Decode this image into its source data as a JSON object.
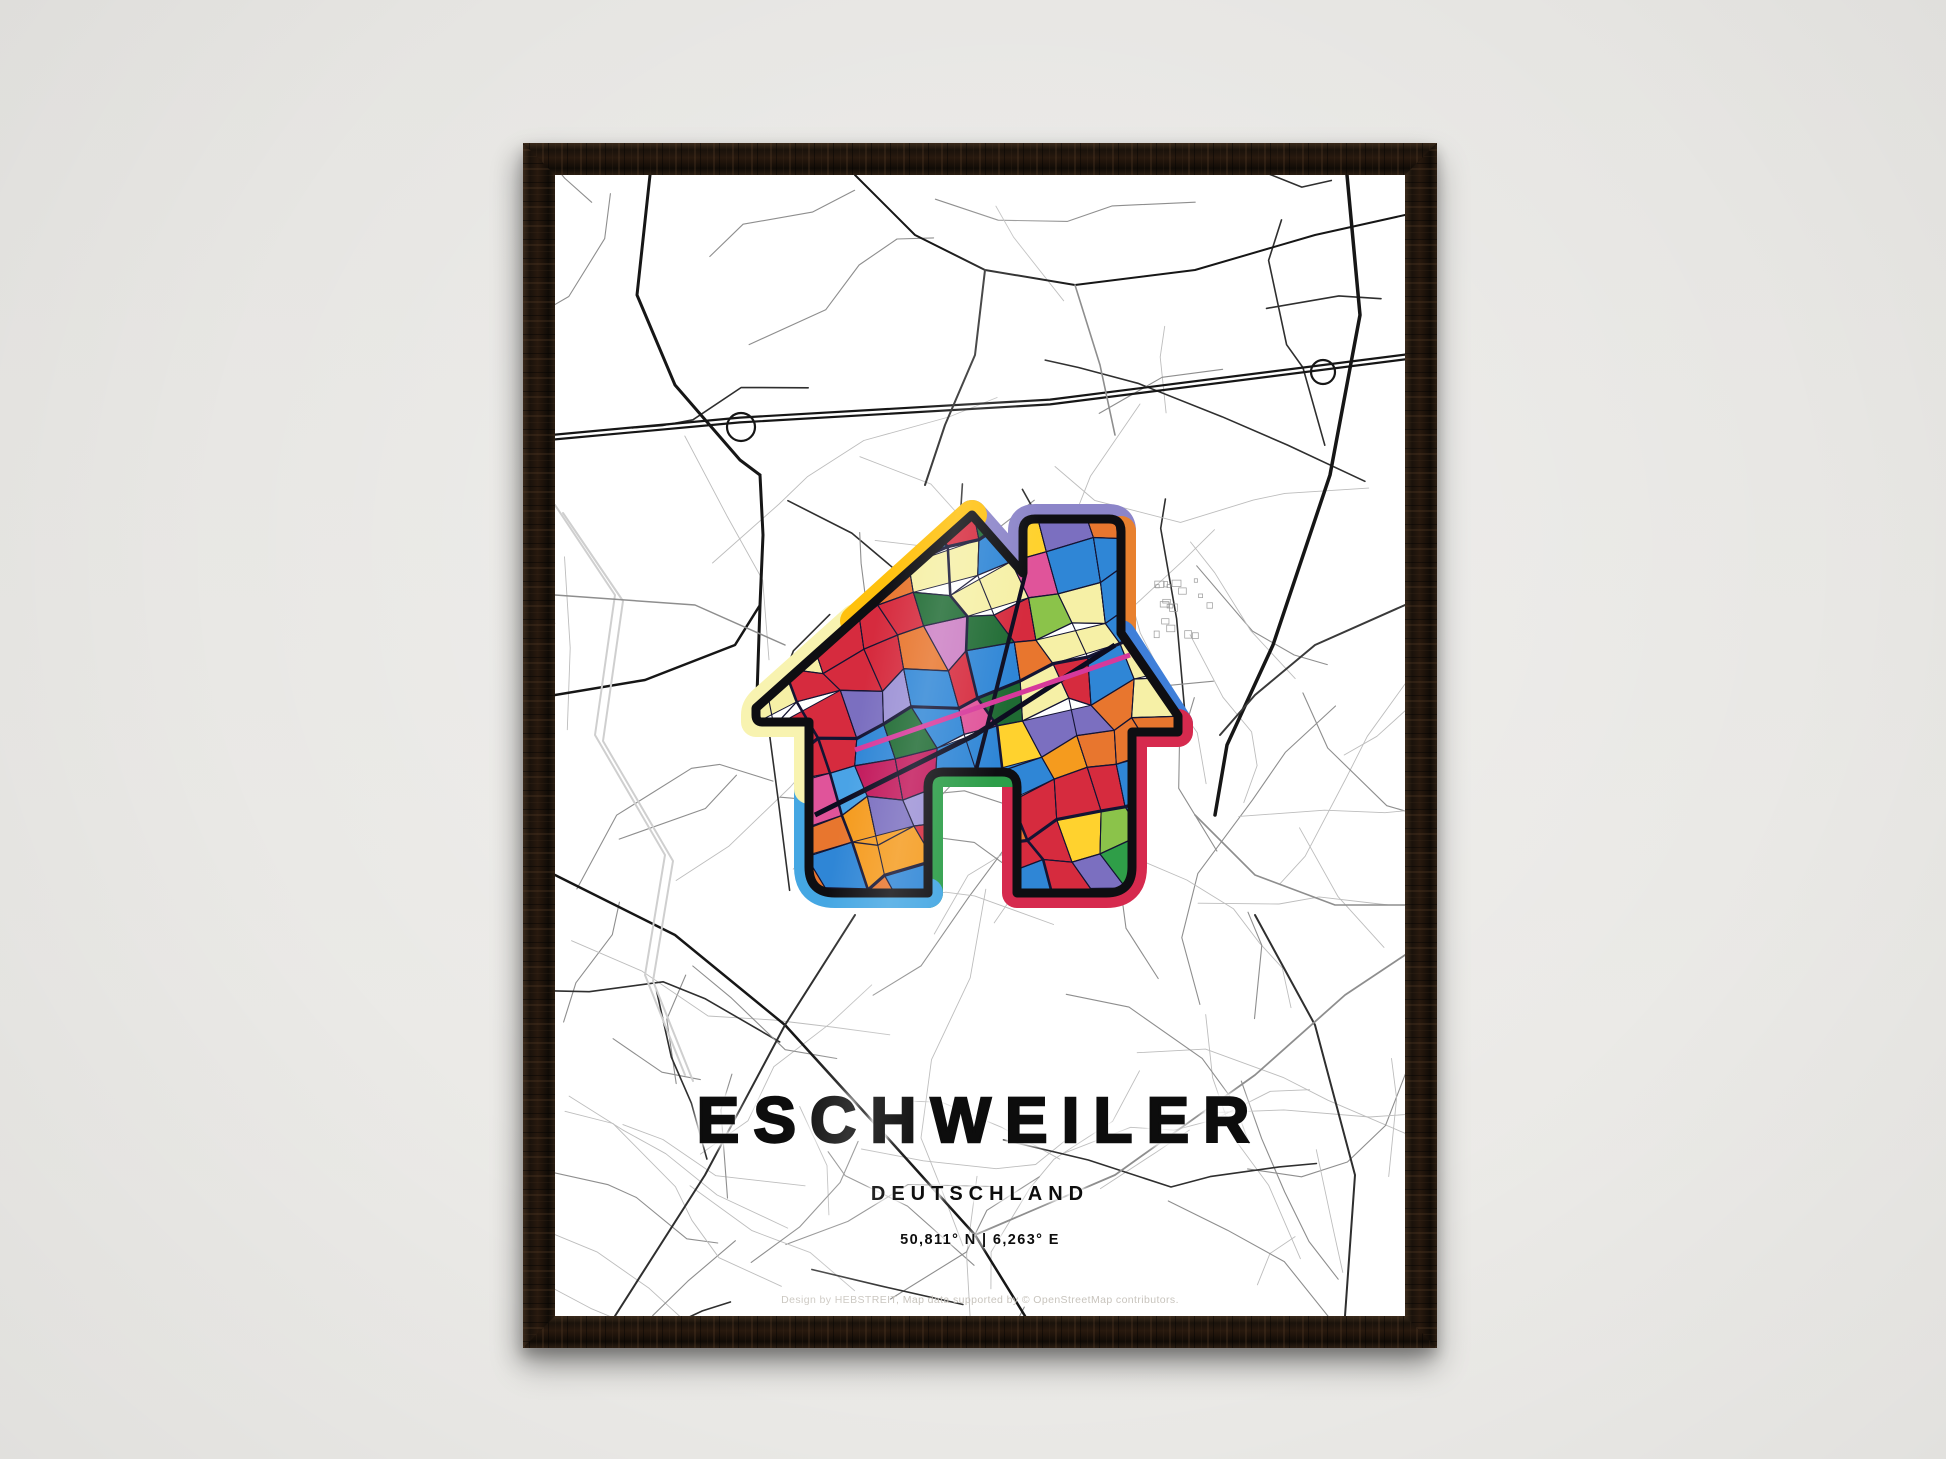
{
  "scene": {
    "wall_color_top": "#e6e5e2",
    "wall_color_bottom": "#edece9",
    "frame_wood_color": "#1c130c"
  },
  "poster": {
    "title": "ESCHWEILER",
    "subtitle": "DEUTSCHLAND",
    "coordinates": "50,811° N | 6,263° E",
    "credit": "Design by HEBSTREIT, Map data supported by © OpenStreetMap contributors.",
    "paper_color": "#ffffff"
  },
  "map": {
    "background": "#ffffff",
    "major_road_color": "#161616",
    "minor_road_colors": [
      "#bdbdbd",
      "#8e8e8e",
      "#2f2f2f"
    ],
    "water_color": "#cfcfcf",
    "building_color": "#9a9a9a",
    "roads": [
      {
        "w": 2.2,
        "c": "#161616",
        "double": true,
        "pts": [
          [
            0,
            262
          ],
          [
            185,
            245
          ],
          [
            495,
            227
          ],
          [
            850,
            182
          ]
        ]
      },
      {
        "circle": [
          186,
          252,
          14
        ],
        "w": 2.2,
        "c": "#161616"
      },
      {
        "circle": [
          768,
          197,
          12
        ],
        "w": 2.2,
        "c": "#161616"
      },
      {
        "w": 3,
        "c": "#161616",
        "pts": [
          [
            95,
            0
          ],
          [
            82,
            120
          ],
          [
            120,
            210
          ],
          [
            185,
            285
          ],
          [
            205,
            300
          ]
        ]
      },
      {
        "w": 3,
        "c": "#161616",
        "pts": [
          [
            205,
            300
          ],
          [
            208,
            360
          ],
          [
            205,
            430
          ],
          [
            202,
            520
          ]
        ]
      },
      {
        "w": 2.5,
        "c": "#161616",
        "pts": [
          [
            0,
            520
          ],
          [
            90,
            505
          ],
          [
            180,
            470
          ],
          [
            205,
            430
          ]
        ]
      },
      {
        "w": 3.5,
        "c": "#161616",
        "pts": [
          [
            792,
            0
          ],
          [
            805,
            140
          ],
          [
            775,
            300
          ],
          [
            718,
            470
          ],
          [
            672,
            570
          ],
          [
            660,
            640
          ]
        ]
      },
      {
        "w": 2,
        "c": "#3a3a3a",
        "pts": [
          [
            850,
            430
          ],
          [
            760,
            470
          ],
          [
            700,
            520
          ],
          [
            665,
            560
          ]
        ]
      },
      {
        "w": 2.5,
        "c": "#161616",
        "pts": [
          [
            0,
            700
          ],
          [
            120,
            760
          ],
          [
            230,
            850
          ],
          [
            330,
            960
          ],
          [
            420,
            1060
          ],
          [
            470,
            1141
          ]
        ]
      },
      {
        "w": 2,
        "c": "#2f2f2f",
        "pts": [
          [
            60,
            1141
          ],
          [
            150,
            1000
          ],
          [
            230,
            850
          ],
          [
            300,
            740
          ]
        ]
      },
      {
        "w": 2,
        "c": "#2f2f2f",
        "pts": [
          [
            700,
            740
          ],
          [
            760,
            850
          ],
          [
            800,
            1000
          ],
          [
            790,
            1141
          ]
        ]
      },
      {
        "w": 1.8,
        "c": "#8e8e8e",
        "pts": [
          [
            420,
            1060
          ],
          [
            560,
            1000
          ],
          [
            700,
            900
          ],
          [
            790,
            820
          ],
          [
            850,
            780
          ]
        ]
      },
      {
        "w": 2,
        "c": "#cfcfcf",
        "pts": [
          [
            0,
            330
          ],
          [
            60,
            420
          ],
          [
            40,
            560
          ],
          [
            110,
            680
          ],
          [
            90,
            800
          ],
          [
            130,
            900
          ]
        ]
      },
      {
        "w": 2,
        "c": "#cfcfcf",
        "pts": [
          [
            8,
            338
          ],
          [
            68,
            426
          ],
          [
            48,
            566
          ],
          [
            118,
            686
          ],
          [
            98,
            806
          ],
          [
            138,
            906
          ]
        ]
      },
      {
        "w": 1.5,
        "c": "#8e8e8e",
        "pts": [
          [
            0,
            420
          ],
          [
            140,
            430
          ],
          [
            230,
            470
          ]
        ]
      },
      {
        "w": 2,
        "c": "#161616",
        "pts": [
          [
            300,
            0
          ],
          [
            360,
            60
          ],
          [
            430,
            95
          ],
          [
            520,
            110
          ],
          [
            640,
            95
          ],
          [
            760,
            60
          ],
          [
            850,
            40
          ]
        ]
      },
      {
        "w": 2,
        "c": "#2f2f2f",
        "pts": [
          [
            430,
            95
          ],
          [
            420,
            180
          ],
          [
            390,
            250
          ],
          [
            370,
            310
          ]
        ]
      },
      {
        "w": 1.6,
        "c": "#8e8e8e",
        "pts": [
          [
            520,
            110
          ],
          [
            545,
            190
          ],
          [
            560,
            260
          ]
        ]
      },
      {
        "w": 1.6,
        "c": "#8e8e8e",
        "pts": [
          [
            640,
            640
          ],
          [
            700,
            700
          ],
          [
            780,
            730
          ],
          [
            850,
            730
          ]
        ]
      }
    ]
  },
  "house_art": {
    "outline_color": "#0e0e12",
    "outline_path": "M417,340 L468,398 L468,356 Q468,344 480,344 L554,344 Q566,344 566,356 L566,458 L623,541 L623,557 L577,557 L577,692 Q577,718 551,718 L462,718 L462,612 Q462,597 447,597 L388,597 Q373,597 373,612 L373,718 L280,718 Q254,718 254,692 L254,547 L207,547 Q201,547 201,540 L201,533 Z",
    "border_bands": [
      {
        "name": "roof-top-right-lavender",
        "color": "#8c85c9",
        "path": "M566,356 Q566,344 554,344 L480,344 Q468,344 468,356 L468,398 L417,340"
      },
      {
        "name": "chimney-right-orange",
        "color": "#e8812f",
        "path": "M566,356 L566,458"
      },
      {
        "name": "right-eave-blue",
        "color": "#3f7fd9",
        "path": "M623,549 L566,460"
      },
      {
        "name": "right-wall-red",
        "color": "#d62a4e",
        "path": "M462,604 L462,718 L551,718 Q577,718 577,692 L577,557 L623,557 L623,549"
      },
      {
        "name": "door-left-green",
        "color": "#2d9e49",
        "path": "M373,718 L373,612 Q373,597 388,597 L462,597"
      },
      {
        "name": "left-wall-lightblue",
        "color": "#45a7e3",
        "path": "M254,612 L254,692 Q254,718 280,718 L373,718"
      },
      {
        "name": "left-eave-paleyellow",
        "color": "#f8f3b0",
        "path": "M300,444 L207,527 Q201,533 201,540 L201,547 L254,547 L254,614"
      },
      {
        "name": "roof-left-gold",
        "color": "#ffc10d",
        "path": "M300,446 L417,340"
      }
    ],
    "street_color": "#141433",
    "accent_road_color": "#d6399b",
    "parcel_palette": [
      {
        "c": "#d62b3e",
        "w": 0.2
      },
      {
        "c": "#2f86d6",
        "w": 0.15
      },
      {
        "c": "#4aa3e6",
        "w": 0.06
      },
      {
        "c": "#e8762e",
        "w": 0.12
      },
      {
        "c": "#f59b1e",
        "w": 0.03
      },
      {
        "c": "#ffd22e",
        "w": 0.06
      },
      {
        "c": "#f6f0a6",
        "w": 0.08
      },
      {
        "c": "#2f9e48",
        "w": 0.05
      },
      {
        "c": "#1f6b33",
        "w": 0.03
      },
      {
        "c": "#8bc34a",
        "w": 0.03
      },
      {
        "c": "#7b6fc0",
        "w": 0.08
      },
      {
        "c": "#9d92d6",
        "w": 0.03
      },
      {
        "c": "#e0549a",
        "w": 0.04
      },
      {
        "c": "#cc7fc4",
        "w": 0.02
      },
      {
        "c": "#c2185b",
        "w": 0.02
      }
    ],
    "mosaic": {
      "x0": 150,
      "y0": 300,
      "x1": 680,
      "y1": 780,
      "rows": 13,
      "cols": 15,
      "angle": -0.3,
      "cx": 415,
      "cy": 530
    }
  }
}
